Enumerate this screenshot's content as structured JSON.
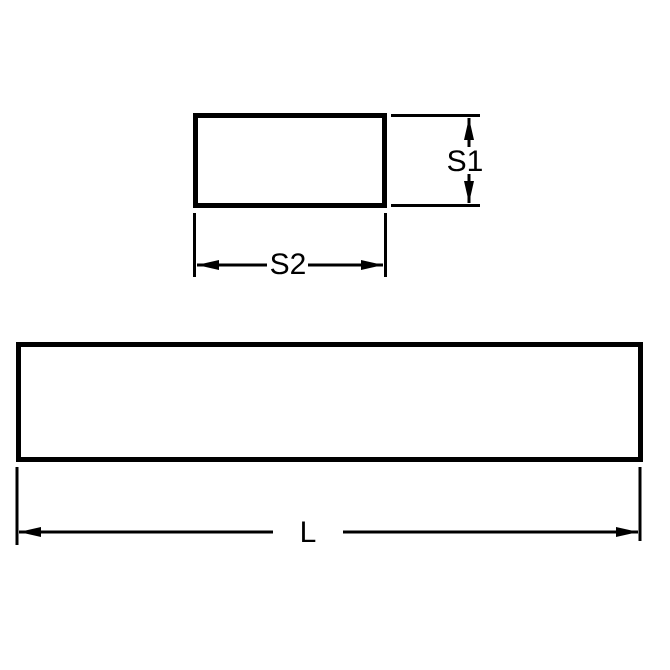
{
  "drawing": {
    "background_color": "#ffffff",
    "stroke_color": "#000000",
    "views": {
      "cross_section": {
        "height_label": "S1",
        "width_label": "S2"
      },
      "side_profile": {
        "length_label": "L"
      }
    }
  }
}
